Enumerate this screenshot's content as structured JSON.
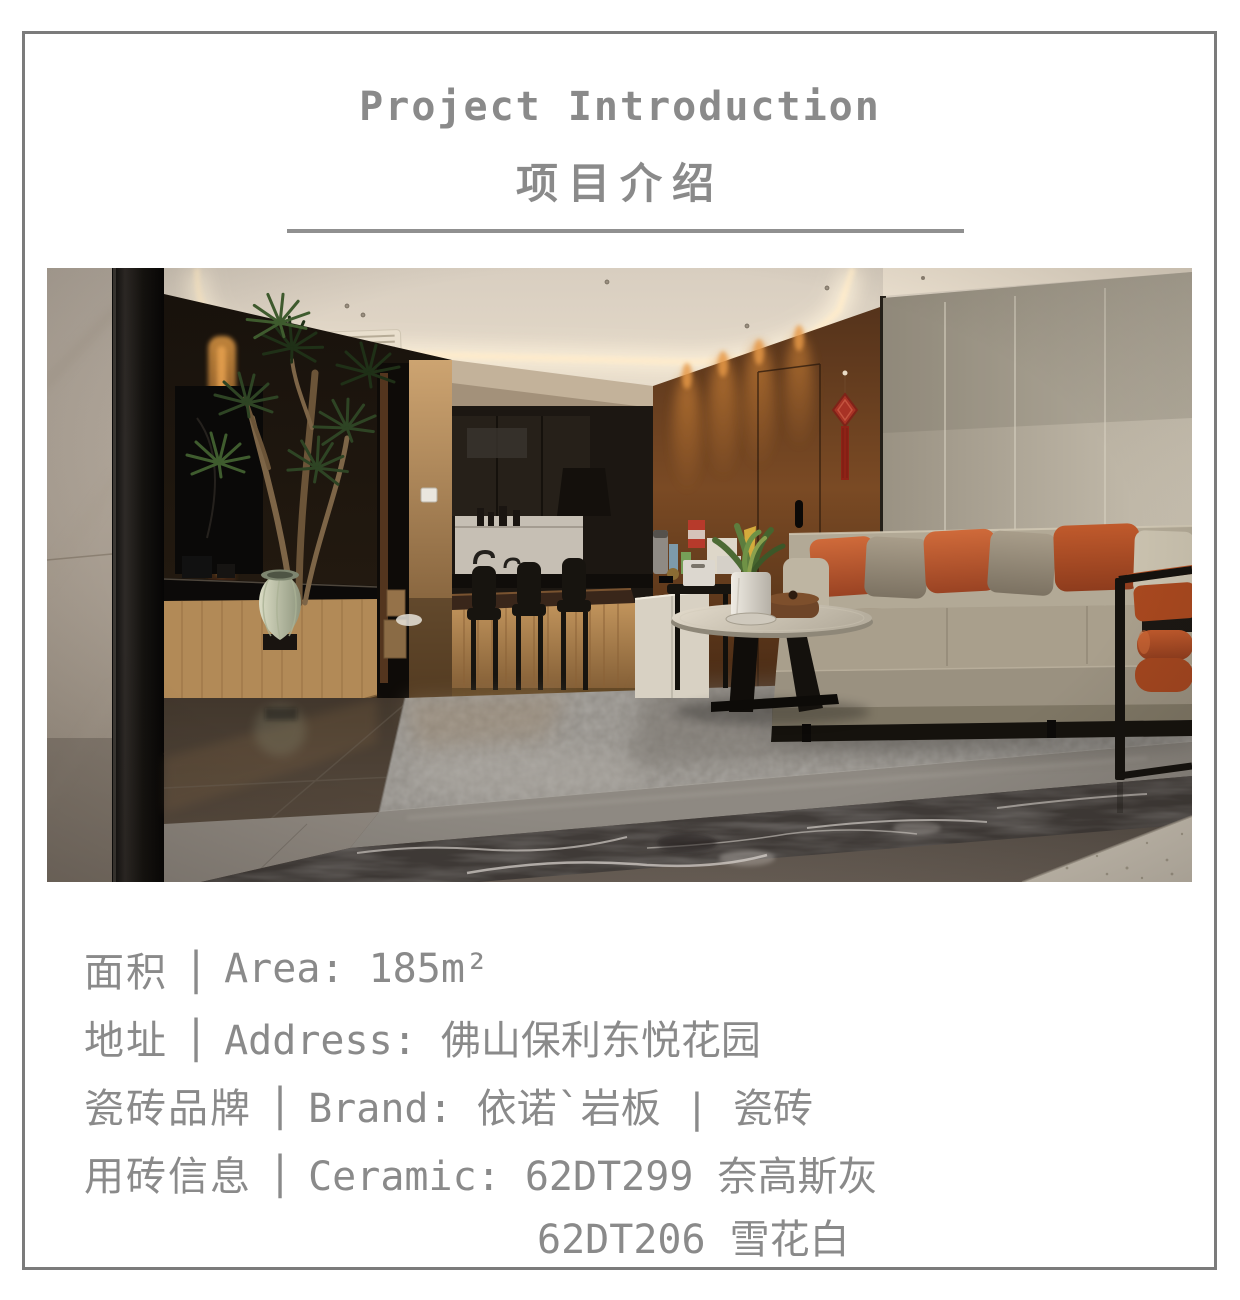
{
  "header": {
    "title": "Project Introduction",
    "subtitle": "项目介绍"
  },
  "photo": {
    "description": "living room interior: cove-lit ceiling, open kitchen bar, warm wood feature wall with red chinese knot, beige panel wall, leather sofa with orange pillows, round coffee table on gray rug, gray marble floor"
  },
  "info": {
    "separator": "|",
    "rows": [
      {
        "label": "面积",
        "value": "Area: 185m²"
      },
      {
        "label": "地址",
        "value": "Address: 佛山保利东悦花园"
      },
      {
        "label": "瓷砖品牌",
        "value": "Brand: 依诺`岩板 | 瓷砖"
      },
      {
        "label": "用砖信息",
        "value": "Ceramic: 62DT299 奈高斯灰"
      },
      {
        "label": "",
        "value": "62DT206 雪花白"
      }
    ]
  },
  "colors": {
    "border": "#7b7b7b",
    "heading": "#8a8a8a",
    "text": "#8a8a8a",
    "divider": "#909090",
    "accent_orange": "#b85731",
    "wood_wall": "#6e4222",
    "panel_wall": "#b9b1a2",
    "knot_red": "#a62e20"
  }
}
